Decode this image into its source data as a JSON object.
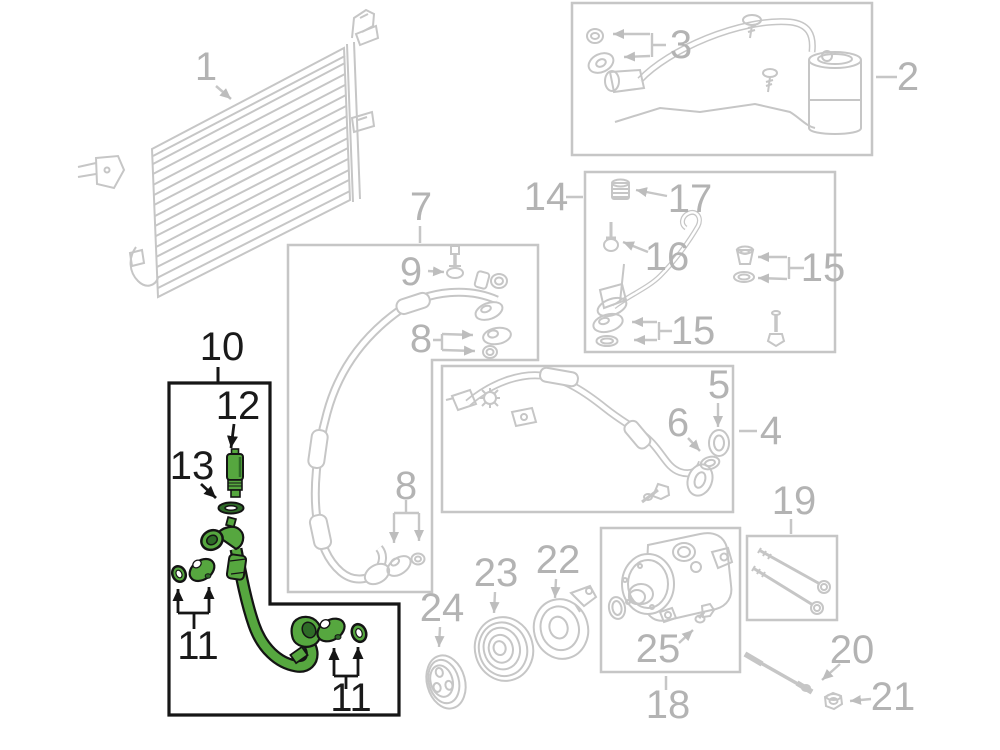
{
  "colors": {
    "page_background": "#ffffff",
    "line_gray": "#c6c6c6",
    "label_gray": "#b3b3b3",
    "outline_black": "#1a1a1a",
    "part_green": "#56a73f",
    "part_green_dark": "#2e6b27"
  },
  "parts": {
    "condenser": {
      "callout": "1"
    },
    "accumulator": {
      "box_callout": "2",
      "seal_kit_callout": "3"
    },
    "liquid_line": {
      "box_callout": "4",
      "ring_callout": "5",
      "oring_callout": "6"
    },
    "suction_hose": {
      "box_callout": "7",
      "seal_callout_upper": "8",
      "seal_callout_lower": "8",
      "valve_callout": "9"
    },
    "ac_hose_highlighted": {
      "highlighted": true,
      "box_callout": "10",
      "seal_callout_left": "11",
      "seal_callout_right": "11",
      "pressure_switch_callout": "12",
      "oring_callout": "13"
    },
    "manifold_tube": {
      "box_callout": "14",
      "seal_callout_right": "15",
      "seal_callout_bottom": "15",
      "valve_callout": "16",
      "cap_callout": "17"
    },
    "compressor": {
      "box_callout": "18",
      "port_callout": "25"
    },
    "mount_bolts": {
      "box_callout": "19"
    },
    "stud_bolt": {
      "callout": "20"
    },
    "nut": {
      "callout": "21"
    },
    "clutch_coil": {
      "callout": "22"
    },
    "clutch_pulley": {
      "callout": "23"
    },
    "clutch_plate": {
      "callout": "24"
    }
  }
}
